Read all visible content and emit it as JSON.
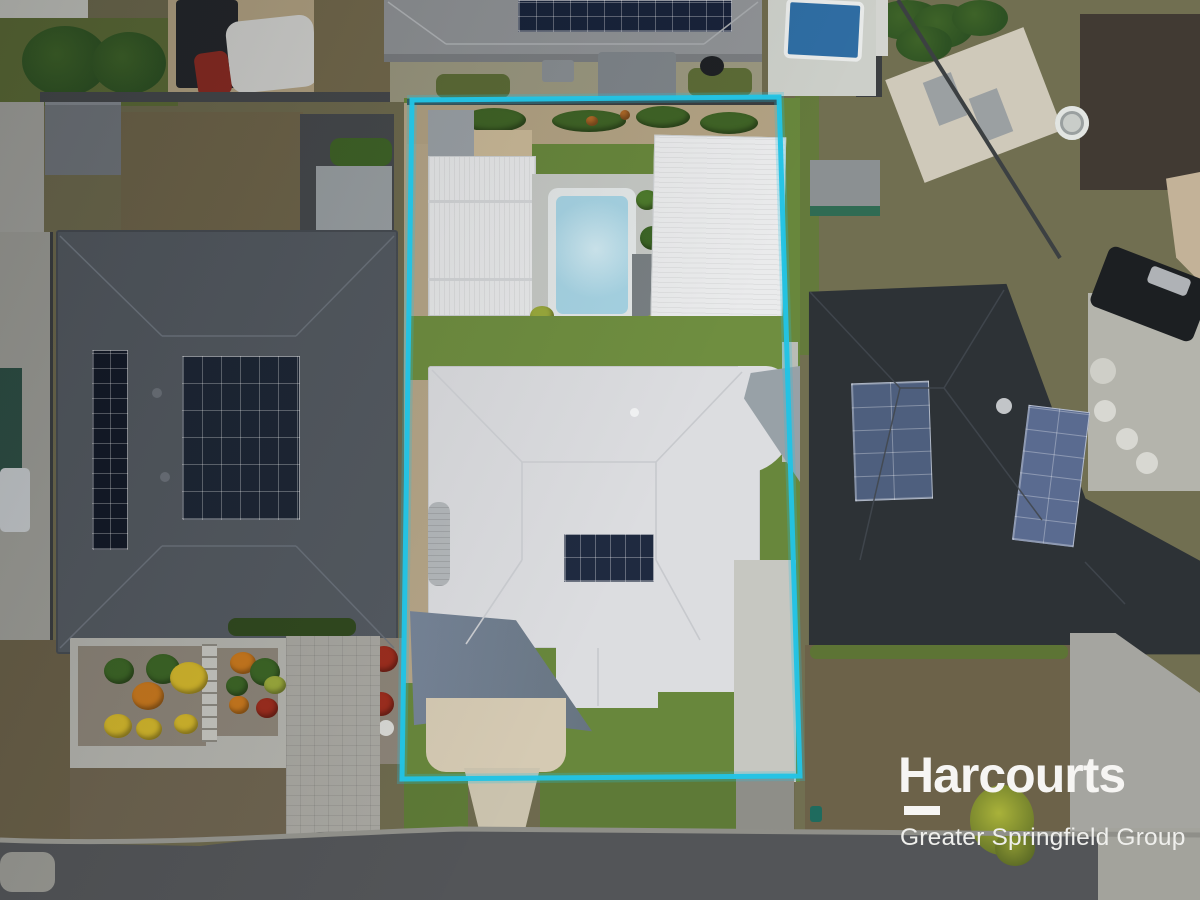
{
  "branding": {
    "name": "Harcourts",
    "tagline": "Greater Springfield Group",
    "logo_style": "white wordmark with underline bar beneath the capital H"
  },
  "overlay": {
    "boundary_shape": "property lot outline",
    "boundary_color": "#22c3e4"
  },
  "colors": {
    "boundary_cyan": "#22c3e4",
    "logo_white": "#f6f5f3",
    "logo_sub": "#efefec",
    "ground_base": "#6e6a4e",
    "road_asphalt": "#535558",
    "road_curb": "#8f8f89",
    "concrete_light": "#c6c7c1",
    "concrete_cream": "#d5cab3",
    "path_cream": "#cbc3ae",
    "paver_gray": "#a8a7a1",
    "paving_light": "#b4b4ae",
    "patio_gray": "#b4b4ac",
    "bottom_concrete": "#a3a39c",
    "left_paving": "#a5a5a0",
    "dark_paving": "#46494c",
    "wall_dark": "#45484b",
    "fence_dark": "#3b3e40",
    "lawn_dark": "#5c6b36",
    "lawn_bright": "#68873c",
    "lawn_mid": "#6f8e40",
    "verge_green": "#5e7a37",
    "right_grass": "#716f51",
    "dead_lawn": "#6f654a",
    "dead_lawn_dark": "#6a6048",
    "dead_lawn_warm": "#73694c",
    "front_dead": "#6c6249",
    "gravel_tan": "#b3a383",
    "soil_tan": "#b2a283",
    "prop_gravel": "#b6a688",
    "bed_gravel": "#8c8478",
    "sand_tan": "#c9b897",
    "roof_left": "#545a61",
    "roof_right": "#2d3236",
    "roof_top": "#8f9295",
    "roof_top_eave": "#7a7d80",
    "roof_far": "#413a33",
    "roof_white": "#e8e9ea",
    "roof_main": "#dcdde0",
    "shed_gray_strip": "#b9bdbf",
    "lean_to": "#9ba1a6",
    "small_bldg": "#71767c",
    "gray_shed": "#9aa0a3",
    "green_shed": "#8b9092",
    "green_shed_teal": "#2f6b53",
    "beige_shed": "#cfc9ba",
    "skylight": "#9ba0a2",
    "teal_structure": "#2e4f45",
    "white_objects": "#c9cdd0",
    "solar_dark": "#131a28",
    "solar_navy": "#18233a",
    "solar_main": "#1f2a40",
    "solar_left_grid": "#1d2635",
    "solar_right_a": "#4e5f7e",
    "solar_right_b": "#5a6b90",
    "pool_coping": "#e3e7e7",
    "pool_water": "#a6d3e3",
    "pool_water_light": "#cfe8f0",
    "pool_paving": "#c5c8c4",
    "np_pool": "#2f6da3",
    "np_paving": "#cccfc9",
    "sail_gray": "#98a1a7",
    "sail_blue_a": "#78869a",
    "sail_blue_b": "#66737f",
    "tan_sail": "#c3b298",
    "trailer_dark": "#1c1f22",
    "canopy_dark": "#23262a",
    "car_cover": "#d5d5d2",
    "car_red": "#8a2a22",
    "hedge_green": "#3f6327",
    "hedge_dark": "#31491f",
    "bush_green": "#3c6526",
    "bush_yellow": "#d2b62c",
    "bush_orange": "#c8781e",
    "bush_red": "#9c2d1e",
    "bush_lime": "#9aa93c",
    "plant_green": "#3f6326",
    "tree_green": "#3e6328",
    "tree_dark": "#2d5123",
    "tank_gray": "#b4b8bb",
    "planter_gray": "#787f82",
    "white_dot": "#d8d8d4",
    "concrete_strip": "#b9bcb6",
    "drive_below": "#8e8e88",
    "pergola": "#7e8489",
    "backyard": "#9a977f",
    "stone": "#d8d8d2",
    "spa": "#c9cdc9",
    "dish": "#c2c5c8"
  }
}
